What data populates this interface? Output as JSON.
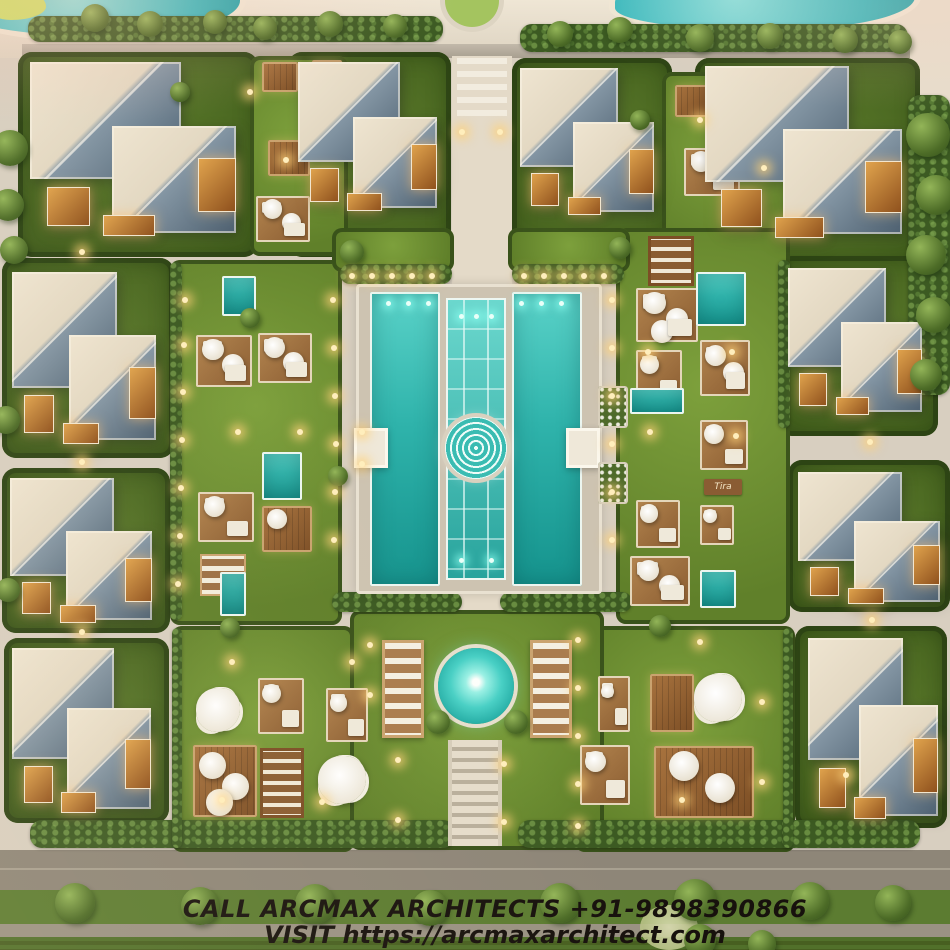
{
  "title": "Aerial 3D site plan render - villa resort with central pools",
  "overlay": {
    "line1": "CALL ARCMAX ARCHITECTS +91-9898390866",
    "line2": "VISIT https://arcmaxarchitect.com"
  },
  "sign": {
    "label": "Tira"
  },
  "palette": {
    "path": "#d8cfc0",
    "grass": "#60802a",
    "hedge": "#3c5a22",
    "pool_turquoise": "#2fb3ab",
    "roof_light": "#e9dfc9",
    "roof_slate": "#536476",
    "deck_wood": "#8a5c31",
    "warm_light": "#ffdf9e",
    "overlay_text": "#17110d",
    "road": "#8e8678"
  },
  "scene": {
    "layers": [
      {
        "c": "sand",
        "n": "top-promenade",
        "x": 0,
        "y": 0,
        "w": 950,
        "h": 58
      },
      {
        "c": "cornerpath",
        "n": "corner-path",
        "x": 900,
        "y": 0,
        "w": 50,
        "h": 100
      },
      {
        "c": "pond",
        "n": "pond-top-left",
        "x": -35,
        "y": -26,
        "w": 275,
        "h": 62
      },
      {
        "c": "pond",
        "n": "pond-top-right",
        "x": 615,
        "y": -28,
        "w": 300,
        "h": 58
      },
      {
        "c": "blob",
        "n": "shrub-blob",
        "x": -12,
        "y": -10,
        "w": 58,
        "h": 30
      },
      {
        "c": "roundabout",
        "n": "roundabout",
        "x": 440,
        "y": -30,
        "w": 64,
        "h": 62
      },
      {
        "c": "wallband",
        "n": "boundary-wall",
        "x": 22,
        "y": 44,
        "w": 888,
        "h": 14
      },
      {
        "c": "road",
        "n": "road-bottom",
        "x": 0,
        "y": 850,
        "w": 950,
        "h": 40
      },
      {
        "c": "lane",
        "n": "lane-line",
        "x": 0,
        "y": 868,
        "w": 950,
        "h": 2
      },
      {
        "c": "median",
        "n": "median-green",
        "x": 0,
        "y": 890,
        "w": 950,
        "h": 34
      },
      {
        "c": "road2",
        "n": "road-outer",
        "x": 0,
        "y": 924,
        "w": 950,
        "h": 13
      },
      {
        "c": "field",
        "n": "field",
        "x": 0,
        "y": 937,
        "w": 950,
        "h": 13
      },
      {
        "c": "spine",
        "n": "central-walkway",
        "x": 452,
        "y": 56,
        "w": 60,
        "h": 558
      },
      {
        "c": "crosswalk",
        "n": "crosswalk",
        "x": 457,
        "y": 58,
        "w": 50,
        "h": 58
      },
      {
        "c": "plot",
        "n": "villa-plot",
        "x": 18,
        "y": 52,
        "w": 240,
        "h": 205
      },
      {
        "c": "plot",
        "n": "villa-plot",
        "x": 288,
        "y": 52,
        "w": 163,
        "h": 205
      },
      {
        "c": "plot",
        "n": "villa-plot",
        "x": 512,
        "y": 58,
        "w": 160,
        "h": 202
      },
      {
        "c": "plot",
        "n": "villa-plot",
        "x": 695,
        "y": 58,
        "w": 225,
        "h": 207
      },
      {
        "c": "plot",
        "n": "villa-plot",
        "x": 2,
        "y": 258,
        "w": 172,
        "h": 200
      },
      {
        "c": "plot",
        "n": "villa-plot",
        "x": 2,
        "y": 468,
        "w": 168,
        "h": 165
      },
      {
        "c": "plot",
        "n": "villa-plot",
        "x": 4,
        "y": 638,
        "w": 165,
        "h": 185
      },
      {
        "c": "plot",
        "n": "villa-plot",
        "x": 778,
        "y": 256,
        "w": 160,
        "h": 180
      },
      {
        "c": "plot",
        "n": "villa-plot",
        "x": 788,
        "y": 460,
        "w": 162,
        "h": 152
      },
      {
        "c": "plot",
        "n": "villa-plot",
        "x": 795,
        "y": 626,
        "w": 152,
        "h": 202
      },
      {
        "c": "lawn",
        "n": "courtyard-lawn",
        "x": 250,
        "y": 56,
        "w": 98,
        "h": 200
      },
      {
        "c": "lawn",
        "n": "courtyard-lawn",
        "x": 662,
        "y": 72,
        "w": 128,
        "h": 192
      },
      {
        "c": "lawn",
        "n": "courtyard-lawn",
        "x": 170,
        "y": 260,
        "w": 172,
        "h": 365
      },
      {
        "c": "lawn",
        "n": "courtyard-lawn",
        "x": 616,
        "y": 228,
        "w": 174,
        "h": 396
      },
      {
        "c": "lawn",
        "n": "courtyard-lawn",
        "x": 332,
        "y": 228,
        "w": 122,
        "h": 44
      },
      {
        "c": "lawn",
        "n": "courtyard-lawn",
        "x": 508,
        "y": 228,
        "w": 122,
        "h": 44
      },
      {
        "c": "lawn",
        "n": "courtyard-lawn",
        "x": 172,
        "y": 626,
        "w": 182,
        "h": 226
      },
      {
        "c": "lawn",
        "n": "courtyard-lawn",
        "x": 575,
        "y": 626,
        "w": 220,
        "h": 226
      },
      {
        "c": "lawn",
        "n": "round-pool-lawn",
        "x": 350,
        "y": 610,
        "w": 254,
        "h": 240
      },
      {
        "c": "hedge",
        "n": "hedge-row",
        "x": 28,
        "y": 16,
        "w": 415,
        "h": 26
      },
      {
        "c": "hedge",
        "n": "hedge-row",
        "x": 520,
        "y": 24,
        "w": 388,
        "h": 28
      },
      {
        "c": "hedge",
        "n": "hedge-row",
        "x": 30,
        "y": 820,
        "w": 425,
        "h": 28
      },
      {
        "c": "hedge",
        "n": "hedge-row",
        "x": 518,
        "y": 820,
        "w": 402,
        "h": 28
      },
      {
        "c": "hedge",
        "n": "hedge-row",
        "x": 340,
        "y": 264,
        "w": 112,
        "h": 20
      },
      {
        "c": "hedge",
        "n": "hedge-row",
        "x": 512,
        "y": 264,
        "w": 112,
        "h": 20
      },
      {
        "c": "hedge",
        "n": "hedge-row",
        "x": 332,
        "y": 592,
        "w": 130,
        "h": 20
      },
      {
        "c": "hedge",
        "n": "hedge-row",
        "x": 500,
        "y": 592,
        "w": 132,
        "h": 20
      },
      {
        "c": "hedge",
        "n": "hedge-row",
        "x": 170,
        "y": 262,
        "w": 12,
        "h": 358
      },
      {
        "c": "hedge",
        "n": "hedge-row",
        "x": 778,
        "y": 260,
        "w": 12,
        "h": 168
      },
      {
        "c": "hedge",
        "n": "hedge-row",
        "x": 172,
        "y": 628,
        "w": 10,
        "h": 220
      },
      {
        "c": "hedge",
        "n": "hedge-row",
        "x": 783,
        "y": 628,
        "w": 10,
        "h": 220
      },
      {
        "c": "hedge",
        "n": "tree-band-right",
        "x": 908,
        "y": 95,
        "w": 42,
        "h": 300
      },
      {
        "c": "pool-deck",
        "n": "main-pool-deck",
        "x": 356,
        "y": 284,
        "w": 246,
        "h": 310
      },
      {
        "c": "pool",
        "n": "main-pool-left",
        "x": 370,
        "y": 292,
        "w": 70,
        "h": 294
      },
      {
        "c": "pool",
        "n": "main-pool-right",
        "x": 512,
        "y": 292,
        "w": 70,
        "h": 294
      },
      {
        "c": "channel",
        "n": "pool-channel",
        "x": 446,
        "y": 298,
        "w": 60,
        "h": 282
      },
      {
        "c": "spiral",
        "n": "spiral-fountain",
        "x": 445,
        "y": 417,
        "w": 62,
        "h": 62
      },
      {
        "c": "platform",
        "n": "pool-platform-left",
        "x": 354,
        "y": 428,
        "w": 34,
        "h": 40
      },
      {
        "c": "platform",
        "n": "pool-platform-right",
        "x": 566,
        "y": 428,
        "w": 34,
        "h": 40
      },
      {
        "c": "planter",
        "n": "flower-planter",
        "x": 598,
        "y": 386,
        "w": 30,
        "h": 42
      },
      {
        "c": "planter",
        "n": "flower-planter",
        "x": 598,
        "y": 462,
        "w": 30,
        "h": 42
      },
      {
        "c": "round-pool",
        "n": "round-pool",
        "x": 438,
        "y": 648,
        "w": 76,
        "h": 76
      },
      {
        "c": "sundeck",
        "n": "sunbed-deck-left",
        "x": 382,
        "y": 640,
        "w": 42,
        "h": 98
      },
      {
        "c": "sundeck",
        "n": "sunbed-deck-right",
        "x": 530,
        "y": 640,
        "w": 42,
        "h": 98
      },
      {
        "c": "stairs",
        "n": "grand-stairs",
        "x": 448,
        "y": 740,
        "w": 54,
        "h": 106
      },
      {
        "c": "glowbush",
        "n": "lit-bush",
        "x": 640,
        "y": 905,
        "w": 58,
        "h": 45
      }
    ],
    "decks": [
      {
        "t": "wood",
        "x": 262,
        "y": 62,
        "w": 36,
        "h": 30
      },
      {
        "t": "wood",
        "x": 312,
        "y": 60,
        "w": 30,
        "h": 30
      },
      {
        "t": "wood",
        "x": 268,
        "y": 140,
        "w": 42,
        "h": 36
      },
      {
        "t": "white",
        "x": 256,
        "y": 196,
        "w": 54,
        "h": 46,
        "u": 2
      },
      {
        "t": "wood",
        "x": 675,
        "y": 85,
        "w": 36,
        "h": 32
      },
      {
        "t": "white",
        "x": 684,
        "y": 148,
        "w": 56,
        "h": 48,
        "u": 2
      },
      {
        "t": "wood",
        "x": 748,
        "y": 92,
        "w": 34,
        "h": 30
      },
      {
        "t": "white",
        "x": 196,
        "y": 335,
        "w": 56,
        "h": 52,
        "u": 2
      },
      {
        "t": "white",
        "x": 258,
        "y": 333,
        "w": 54,
        "h": 50,
        "u": 2
      },
      {
        "t": "white",
        "x": 198,
        "y": 492,
        "w": 56,
        "h": 50,
        "u": 1
      },
      {
        "t": "wood",
        "x": 262,
        "y": 506,
        "w": 50,
        "h": 46,
        "u": 1
      },
      {
        "t": "sun",
        "x": 200,
        "y": 554,
        "w": 46,
        "h": 42
      },
      {
        "t": "shelf",
        "x": 648,
        "y": 236,
        "w": 46,
        "h": 50
      },
      {
        "t": "white",
        "x": 636,
        "y": 288,
        "w": 62,
        "h": 54,
        "u": 3
      },
      {
        "t": "white",
        "x": 636,
        "y": 350,
        "w": 46,
        "h": 52,
        "u": 1
      },
      {
        "t": "white",
        "x": 700,
        "y": 340,
        "w": 50,
        "h": 56,
        "u": 2
      },
      {
        "t": "white",
        "x": 700,
        "y": 420,
        "w": 48,
        "h": 50,
        "u": 1
      },
      {
        "t": "white",
        "x": 636,
        "y": 500,
        "w": 44,
        "h": 48,
        "u": 1
      },
      {
        "t": "white",
        "x": 700,
        "y": 505,
        "w": 34,
        "h": 40,
        "u": 1
      },
      {
        "t": "white",
        "x": 630,
        "y": 556,
        "w": 60,
        "h": 50,
        "u": 2
      },
      {
        "t": "white",
        "x": 598,
        "y": 676,
        "w": 32,
        "h": 56,
        "u": 1
      },
      {
        "t": "wood",
        "x": 650,
        "y": 674,
        "w": 44,
        "h": 58
      },
      {
        "t": "bigwood",
        "x": 654,
        "y": 746,
        "w": 100,
        "h": 72,
        "u": 2
      },
      {
        "t": "white",
        "x": 580,
        "y": 745,
        "w": 50,
        "h": 60,
        "u": 1
      },
      {
        "t": "white",
        "x": 258,
        "y": 678,
        "w": 46,
        "h": 56,
        "u": 1
      },
      {
        "t": "white",
        "x": 326,
        "y": 688,
        "w": 42,
        "h": 54,
        "u": 1
      },
      {
        "t": "bigwood",
        "x": 193,
        "y": 745,
        "w": 64,
        "h": 72,
        "u": 3
      },
      {
        "t": "shelf",
        "x": 260,
        "y": 748,
        "w": 44,
        "h": 70
      }
    ],
    "plunge_pools": [
      [
        222,
        276,
        34,
        40
      ],
      [
        262,
        452,
        40,
        48
      ],
      [
        696,
        272,
        50,
        54
      ],
      [
        630,
        388,
        54,
        26
      ],
      [
        700,
        570,
        36,
        38
      ],
      [
        220,
        572,
        26,
        44
      ]
    ],
    "clusters": [
      [
        218,
        710,
        22
      ],
      [
        342,
        780,
        24
      ],
      [
        718,
        698,
        24
      ]
    ],
    "villas": [
      [
        "villa-top-left",
        30,
        62,
        215,
        178
      ],
      [
        "villa-top-midleft",
        298,
        62,
        145,
        152
      ],
      [
        "villa-top-midright",
        520,
        68,
        140,
        150
      ],
      [
        "villa-top-right",
        705,
        66,
        205,
        175
      ],
      [
        "villa-left-upper",
        12,
        272,
        150,
        175
      ],
      [
        "villa-left-mid",
        10,
        478,
        148,
        148
      ],
      [
        "villa-left-lower",
        12,
        648,
        145,
        168
      ],
      [
        "villa-right-upper",
        788,
        268,
        140,
        150
      ],
      [
        "villa-right-mid",
        798,
        472,
        148,
        135
      ],
      [
        "villa-right-lower",
        808,
        638,
        135,
        185
      ]
    ],
    "trees": [
      [
        95,
        18,
        14
      ],
      [
        150,
        24,
        13
      ],
      [
        215,
        22,
        12
      ],
      [
        265,
        28,
        12
      ],
      [
        330,
        24,
        13
      ],
      [
        395,
        26,
        12
      ],
      [
        560,
        34,
        13
      ],
      [
        620,
        30,
        13
      ],
      [
        700,
        38,
        14
      ],
      [
        770,
        36,
        13
      ],
      [
        845,
        40,
        13
      ],
      [
        900,
        42,
        12
      ],
      [
        928,
        135,
        22
      ],
      [
        936,
        195,
        20
      ],
      [
        926,
        255,
        20
      ],
      [
        934,
        315,
        18
      ],
      [
        926,
        375,
        16
      ],
      [
        10,
        148,
        18
      ],
      [
        8,
        205,
        16
      ],
      [
        14,
        250,
        14
      ],
      [
        6,
        420,
        14
      ],
      [
        8,
        590,
        12
      ],
      [
        75,
        903,
        20
      ],
      [
        200,
        906,
        19
      ],
      [
        315,
        904,
        20
      ],
      [
        430,
        908,
        18
      ],
      [
        560,
        903,
        20
      ],
      [
        695,
        900,
        21
      ],
      [
        810,
        901,
        19
      ],
      [
        893,
        903,
        18
      ],
      [
        700,
        940,
        16
      ],
      [
        762,
        944,
        14
      ],
      [
        352,
        252,
        12
      ],
      [
        620,
        248,
        11
      ],
      [
        438,
        722,
        12
      ],
      [
        516,
        722,
        12
      ],
      [
        250,
        318,
        10
      ],
      [
        338,
        476,
        10
      ],
      [
        660,
        626,
        11
      ],
      [
        230,
        628,
        10
      ],
      [
        180,
        92,
        10
      ],
      [
        640,
        120,
        10
      ]
    ],
    "lights": [
      [
        185,
        300
      ],
      [
        184,
        345
      ],
      [
        183,
        392
      ],
      [
        182,
        440
      ],
      [
        181,
        488
      ],
      [
        180,
        536
      ],
      [
        178,
        584
      ],
      [
        333,
        300
      ],
      [
        334,
        348
      ],
      [
        335,
        396
      ],
      [
        336,
        444
      ],
      [
        335,
        492
      ],
      [
        334,
        540
      ],
      [
        612,
        300
      ],
      [
        612,
        348
      ],
      [
        612,
        396
      ],
      [
        612,
        444
      ],
      [
        612,
        492
      ],
      [
        612,
        540
      ],
      [
        578,
        640
      ],
      [
        578,
        688
      ],
      [
        578,
        736
      ],
      [
        578,
        784
      ],
      [
        578,
        826
      ],
      [
        370,
        645
      ],
      [
        370,
        695
      ],
      [
        238,
        432
      ],
      [
        300,
        432
      ],
      [
        648,
        352
      ],
      [
        732,
        352
      ],
      [
        650,
        432
      ],
      [
        736,
        436
      ],
      [
        352,
        276
      ],
      [
        372,
        276
      ],
      [
        392,
        276
      ],
      [
        412,
        276
      ],
      [
        432,
        276
      ],
      [
        524,
        276
      ],
      [
        544,
        276
      ],
      [
        564,
        276
      ],
      [
        584,
        276
      ],
      [
        604,
        276
      ],
      [
        362,
        432
      ],
      [
        362,
        464
      ],
      [
        398,
        760
      ],
      [
        504,
        764
      ],
      [
        398,
        820
      ],
      [
        504,
        822
      ],
      [
        232,
        662
      ],
      [
        352,
        662
      ],
      [
        700,
        642
      ],
      [
        762,
        702
      ],
      [
        222,
        800
      ],
      [
        322,
        802
      ],
      [
        682,
        800
      ],
      [
        762,
        782
      ],
      [
        82,
        252
      ],
      [
        82,
        462
      ],
      [
        82,
        632
      ],
      [
        462,
        132
      ],
      [
        500,
        132
      ],
      [
        870,
        442
      ],
      [
        872,
        620
      ],
      [
        846,
        775
      ],
      [
        250,
        92
      ],
      [
        286,
        160
      ],
      [
        700,
        120
      ],
      [
        764,
        168
      ]
    ],
    "pool_lights": [
      [
        388,
        303
      ],
      [
        408,
        303
      ],
      [
        428,
        303
      ],
      [
        521,
        303
      ],
      [
        541,
        303
      ],
      [
        561,
        303
      ],
      [
        461,
        316
      ],
      [
        476,
        316
      ],
      [
        491,
        316
      ],
      [
        461,
        560
      ],
      [
        491,
        560
      ]
    ]
  }
}
